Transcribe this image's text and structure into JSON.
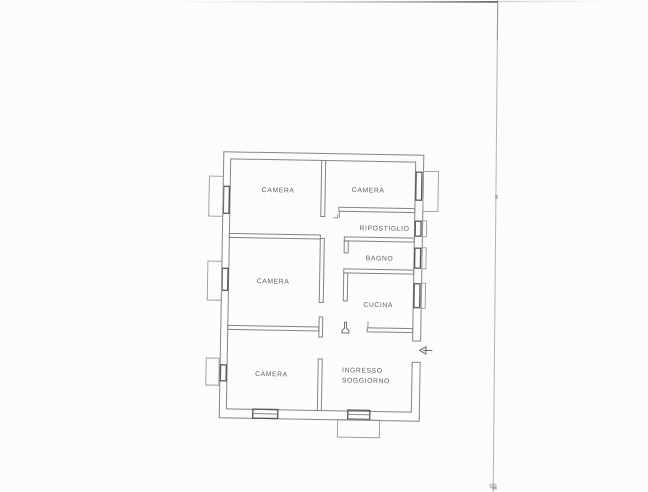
{
  "plan": {
    "rooms": [
      {
        "id": "camera-top-left",
        "label": "CAMERA"
      },
      {
        "id": "camera-top-right",
        "label": "CAMERA"
      },
      {
        "id": "ripostiglio",
        "label": "RIPOSTIGLIO"
      },
      {
        "id": "bagno",
        "label": "BAGNO"
      },
      {
        "id": "cucina",
        "label": "CUCINA"
      },
      {
        "id": "camera-middle-left",
        "label": "CAMERA"
      },
      {
        "id": "camera-bottom-left",
        "label": "CAMERA"
      },
      {
        "id": "ingresso-soggiorno",
        "label": "INGRESSO SOGGIORNO",
        "lines": [
          "INGRESSO",
          "SOGGIORNO"
        ]
      }
    ],
    "icons": {
      "entrance_arrow": "left-pointing-entrance-arrow"
    },
    "colors": {
      "paper": "#fcfcfc",
      "wall_line": "#848484",
      "window_line": "#565656",
      "label_text": "#606060",
      "scan_edge_line": "#b3b3b3"
    }
  }
}
